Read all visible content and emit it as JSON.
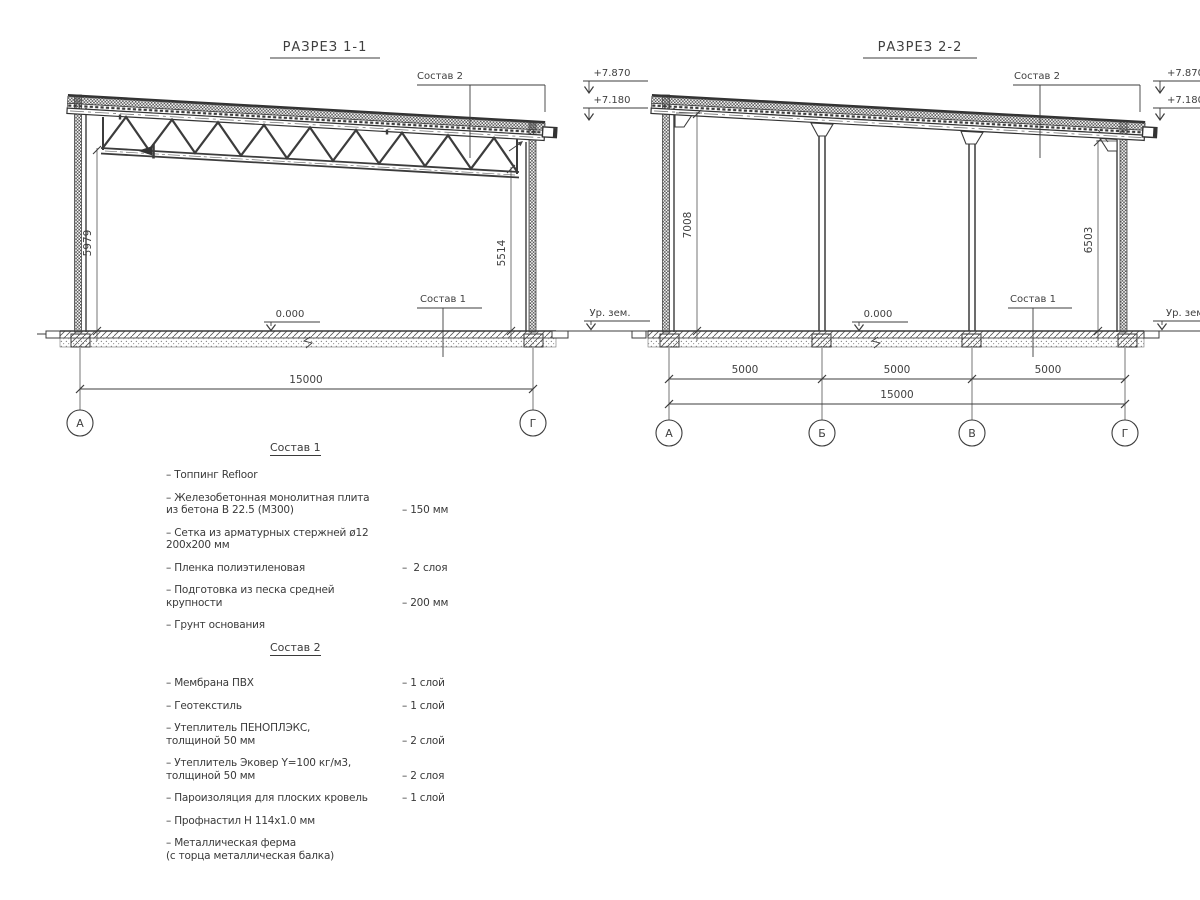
{
  "section1": {
    "title": "РАЗРЕЗ 1-1",
    "sostav2_label": "Состав 2",
    "sostav1_label": "Состав 1",
    "elev_high": "+7.870",
    "elev_low": "+7.180",
    "zero_level": "0.000",
    "ground_level": "Ур. зем.",
    "dim_left": "5979",
    "dim_right": "5514",
    "dim_total": "15000",
    "axis_left": "А",
    "axis_right": "Г"
  },
  "section2": {
    "title": "РАЗРЕЗ 2-2",
    "sostav2_label": "Состав 2",
    "sostav1_label": "Состав 1",
    "elev_high": "+7.870",
    "elev_low": "+7.180",
    "zero_level": "0.000",
    "ground_level": "Ур. зем.",
    "dim_left": "7008",
    "dim_right": "6503",
    "dim_spans": [
      "5000",
      "5000",
      "5000"
    ],
    "dim_total": "15000",
    "axes": [
      "А",
      "Б",
      "В",
      "Г"
    ]
  },
  "sostav1": {
    "title": "Состав 1",
    "items": [
      {
        "label": "– Топпинг Refloor",
        "value": ""
      },
      {
        "label": "– Железобетонная  монолитная плита\nиз бетона В 22.5 (М300)",
        "value": "– 150 мм"
      },
      {
        "label": "– Сетка из арматурных стержней ø12 200х200 мм",
        "value": ""
      },
      {
        "label": "– Пленка полиэтиленовая",
        "value": "–  2 слоя"
      },
      {
        "label": "– Подготовка из песка средней\nкрупности",
        "value": "– 200 мм"
      },
      {
        "label": "– Грунт основания",
        "value": ""
      }
    ]
  },
  "sostav2": {
    "title": "Состав 2",
    "items": [
      {
        "label": "– Мембрана ПВХ",
        "value": "– 1 слой"
      },
      {
        "label": "– Геотекстиль",
        "value": "– 1 слой"
      },
      {
        "label": "– Утеплитель ПЕНОПЛЭКС,\nтолщиной 50 мм",
        "value": "– 2 слой"
      },
      {
        "label": "– Утеплитель Эковер Y=100 кг/м3,\nтолщиной 50 мм",
        "value": "– 2 слоя"
      },
      {
        "label": "– Пароизоляция для плоских кровель",
        "value": "– 1 слой"
      },
      {
        "label": "– Профнастил Н 114х1.0 мм",
        "value": ""
      },
      {
        "label": "– Металлическая ферма\n(с торца металлическая балка)",
        "value": ""
      }
    ]
  }
}
